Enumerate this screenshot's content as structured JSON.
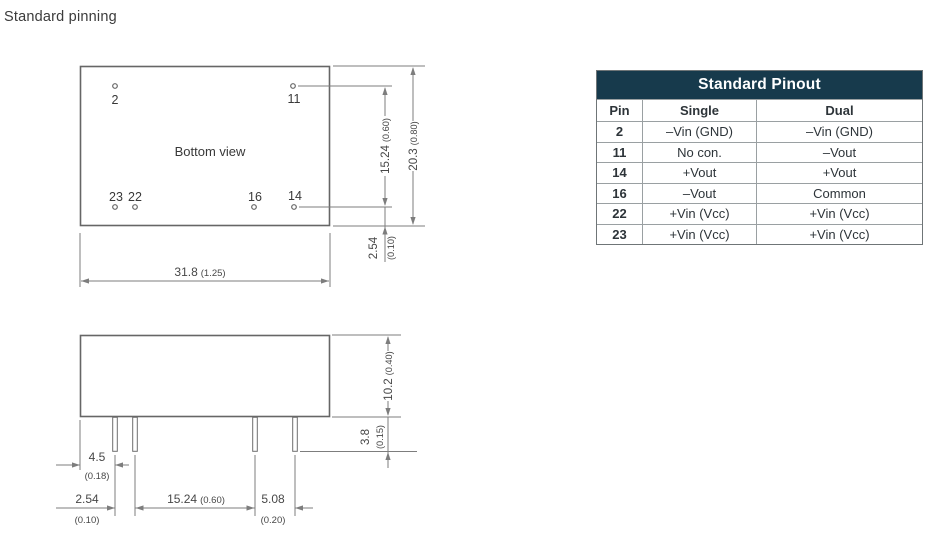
{
  "page": {
    "title": "Standard pinning"
  },
  "bottom_view": {
    "caption": "Bottom view",
    "pin_labels": {
      "top_left": "2",
      "top_right": "11",
      "bottom_far_left": "23",
      "bottom_left": "22",
      "bottom_right": "16",
      "bottom_far_right": "14"
    },
    "dims": {
      "pin_row_spacing": {
        "mm": "15.24",
        "inch": "(0.60)"
      },
      "body_depth": {
        "mm": "20.3",
        "inch": "(0.80)"
      },
      "pin_edge_offset": {
        "mm": "2.54",
        "inch": "(0.10)"
      },
      "body_width": {
        "mm": "31.8",
        "inch": "(1.25)"
      }
    }
  },
  "side_view": {
    "dims": {
      "body_height": {
        "mm": "10.2",
        "inch": "(0.40)"
      },
      "pin_length": {
        "mm": "3.8",
        "inch": "(0.15)"
      },
      "left_edge_to_pin": {
        "mm": "4.5",
        "inch": "(0.18)"
      },
      "pin_pitch": {
        "mm": "2.54",
        "inch": "(0.10)"
      },
      "pin_group_spacing": {
        "mm": "15.24",
        "inch": "(0.60)"
      },
      "right_pin_spacing": {
        "mm": "5.08",
        "inch": "(0.20)"
      }
    }
  },
  "pinout_table": {
    "title": "Standard Pinout",
    "columns": [
      "Pin",
      "Single",
      "Dual"
    ],
    "rows": [
      {
        "pin": "2",
        "single": "–Vin (GND)",
        "dual": "–Vin (GND)"
      },
      {
        "pin": "11",
        "single": "No con.",
        "dual": "–Vout"
      },
      {
        "pin": "14",
        "single": "+Vout",
        "dual": "+Vout"
      },
      {
        "pin": "16",
        "single": "–Vout",
        "dual": "Common"
      },
      {
        "pin": "22",
        "single": "+Vin (Vcc)",
        "dual": "+Vin (Vcc)"
      },
      {
        "pin": "23",
        "single": "+Vin (Vcc)",
        "dual": "+Vin (Vcc)"
      }
    ]
  },
  "colors": {
    "table_header_bg": "#173a4c",
    "drawing_line": "#6e6e6e",
    "dimension_line": "#7d7d7d",
    "text": "#3b3b3b"
  }
}
